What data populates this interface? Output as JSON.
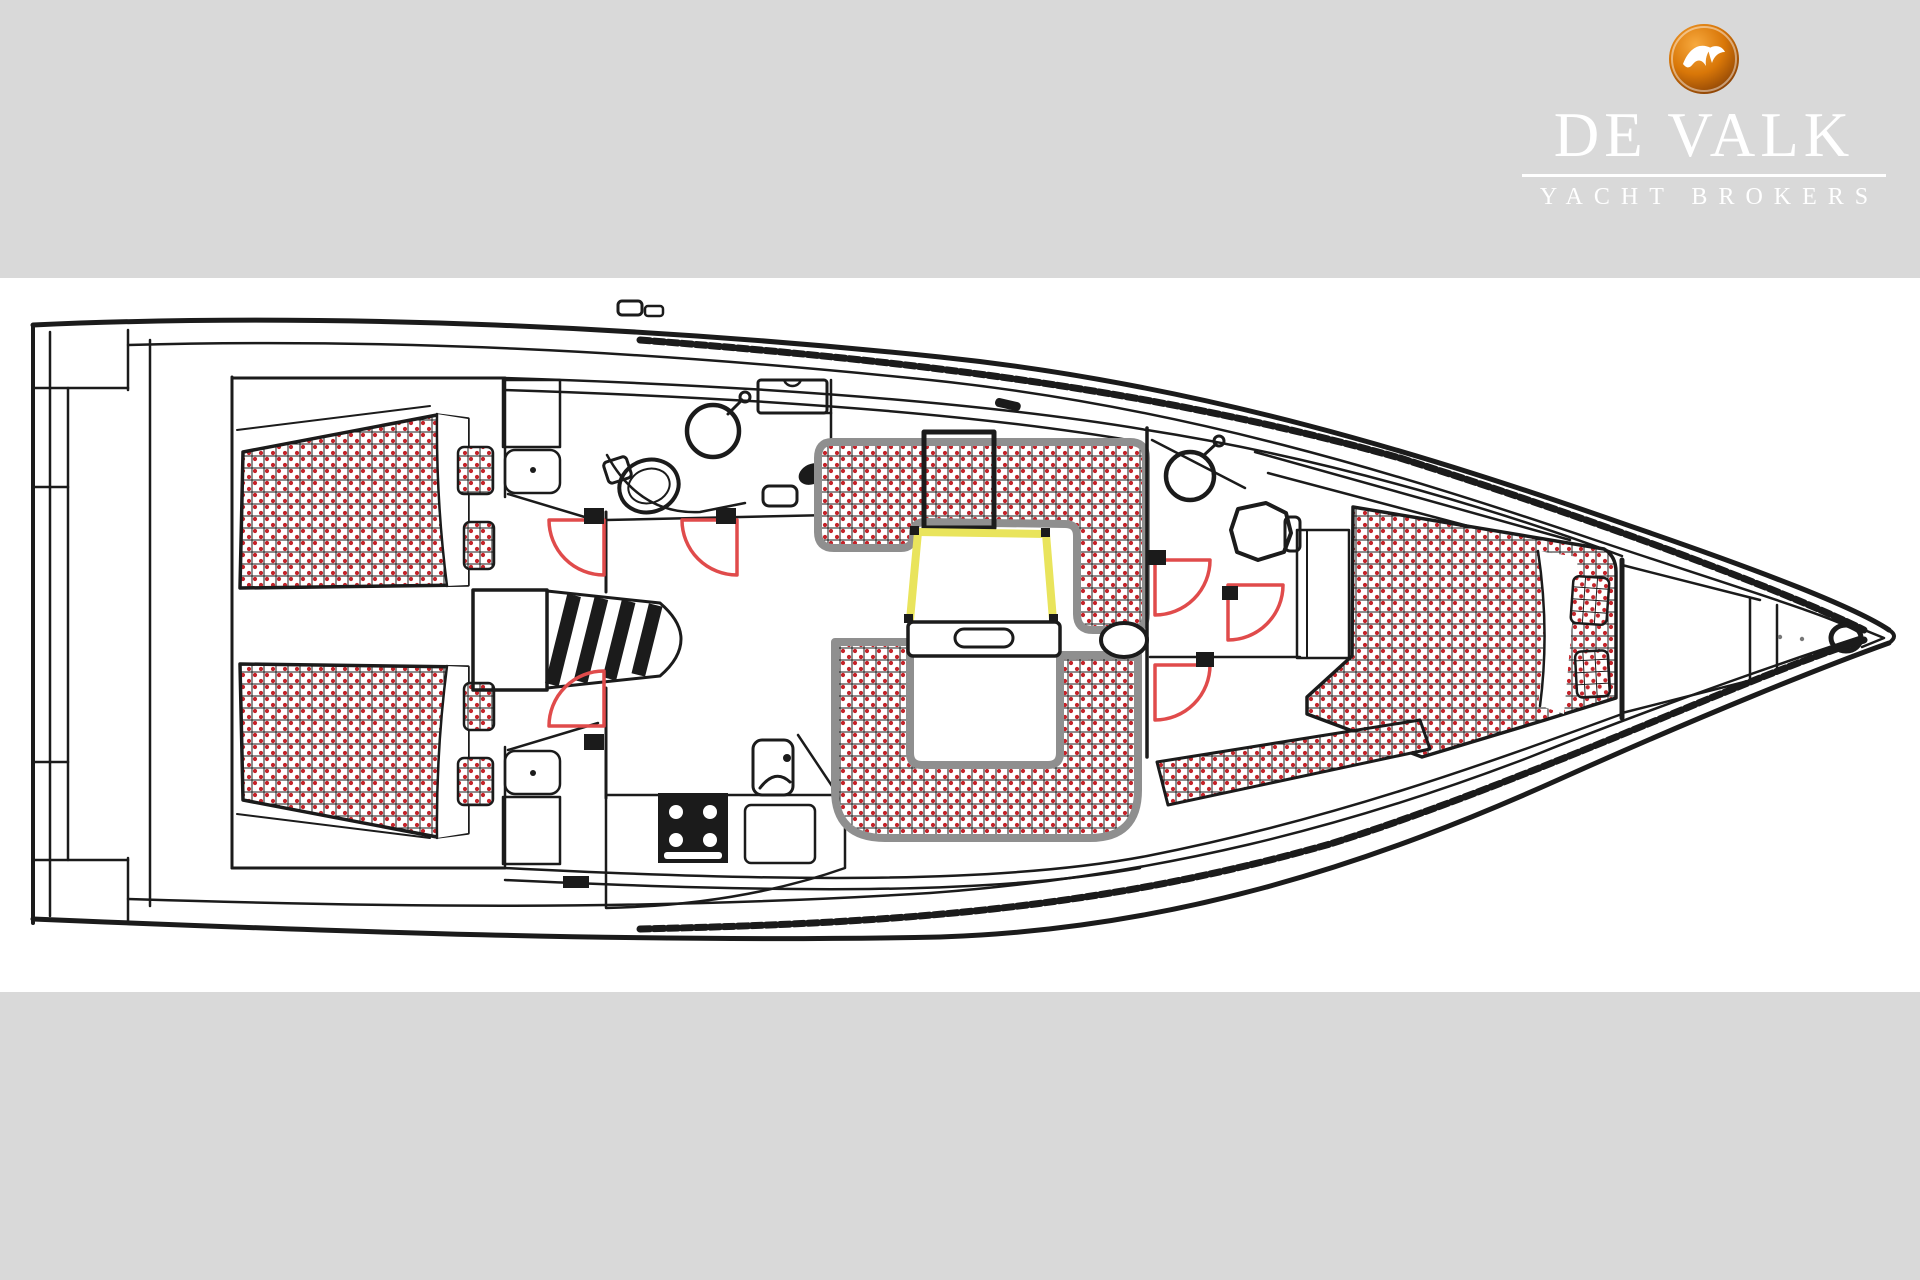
{
  "logo": {
    "brand": "DE VALK",
    "tagline": "YACHT BROKERS",
    "bird_icon": "falcon-icon"
  },
  "colors": {
    "canvas_gray": "#d9d9d9",
    "panel_white": "#ffffff",
    "line_black": "#1b1b1b",
    "upholstery_dot_red": "#c4232a",
    "door_arc_red": "#e04b4b",
    "table_highlight_yellow": "#e9e45c",
    "settee_border_gray": "#8f8f8f",
    "logo_orange_outer": "#8a4206",
    "logo_orange_mid": "#d97708",
    "logo_orange_inner": "#f7a93e",
    "logo_text_white": "#ffffff"
  }
}
